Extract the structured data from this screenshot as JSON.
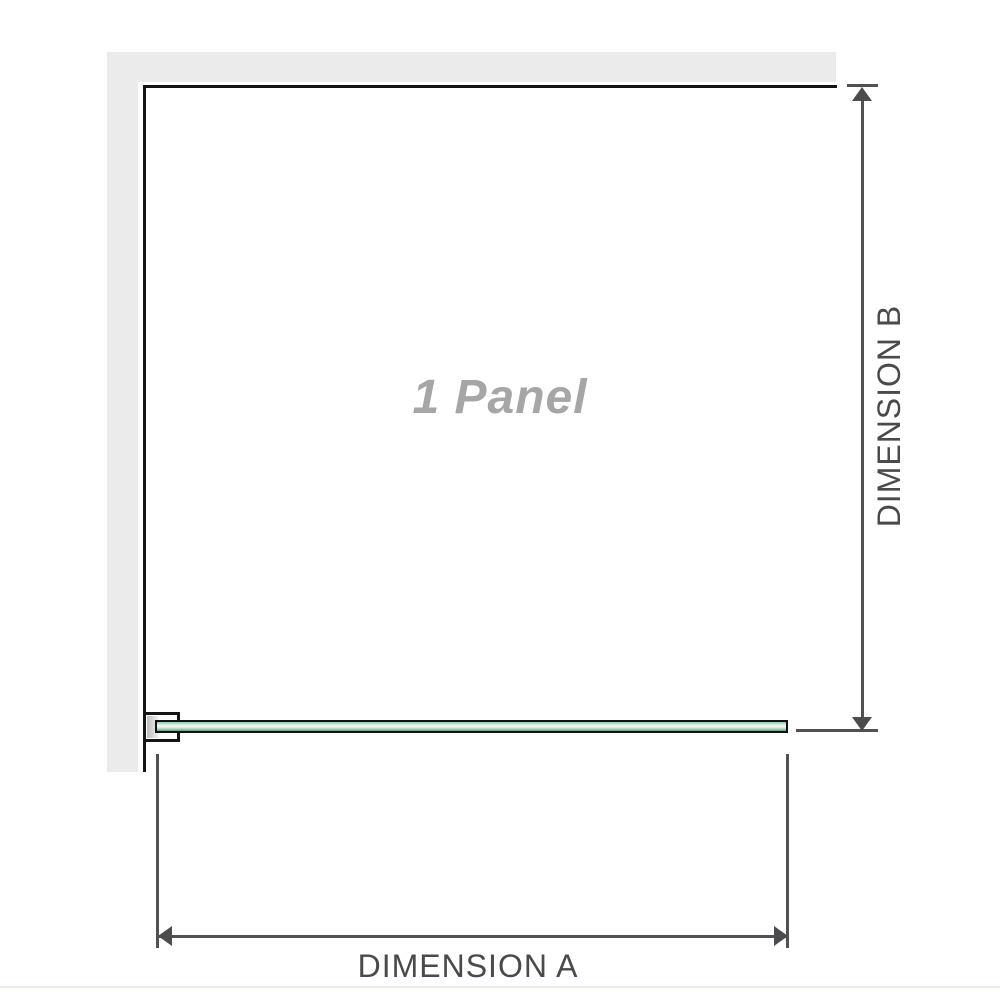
{
  "diagram": {
    "panel_label": "1 Panel",
    "dimension_a_label": "DIMENSION A",
    "dimension_b_label": "DIMENSION B"
  },
  "colors": {
    "wall_fill": "#ebebeb",
    "panel_outline": "#141414",
    "glass_border": "#121212",
    "glass_green_top": "#8ac7a6",
    "glass_green_light": "#f0faf5",
    "glass_green_bottom": "#5f9f81",
    "dimension_line": "#515153",
    "arrowhead": "#4c4c4e",
    "dimension_label_text": "#4a4a4a",
    "panel_label_text": "#a6a6a6",
    "bracket_pad": "#bdbdbd",
    "bottom_rule": "#edebe6"
  }
}
